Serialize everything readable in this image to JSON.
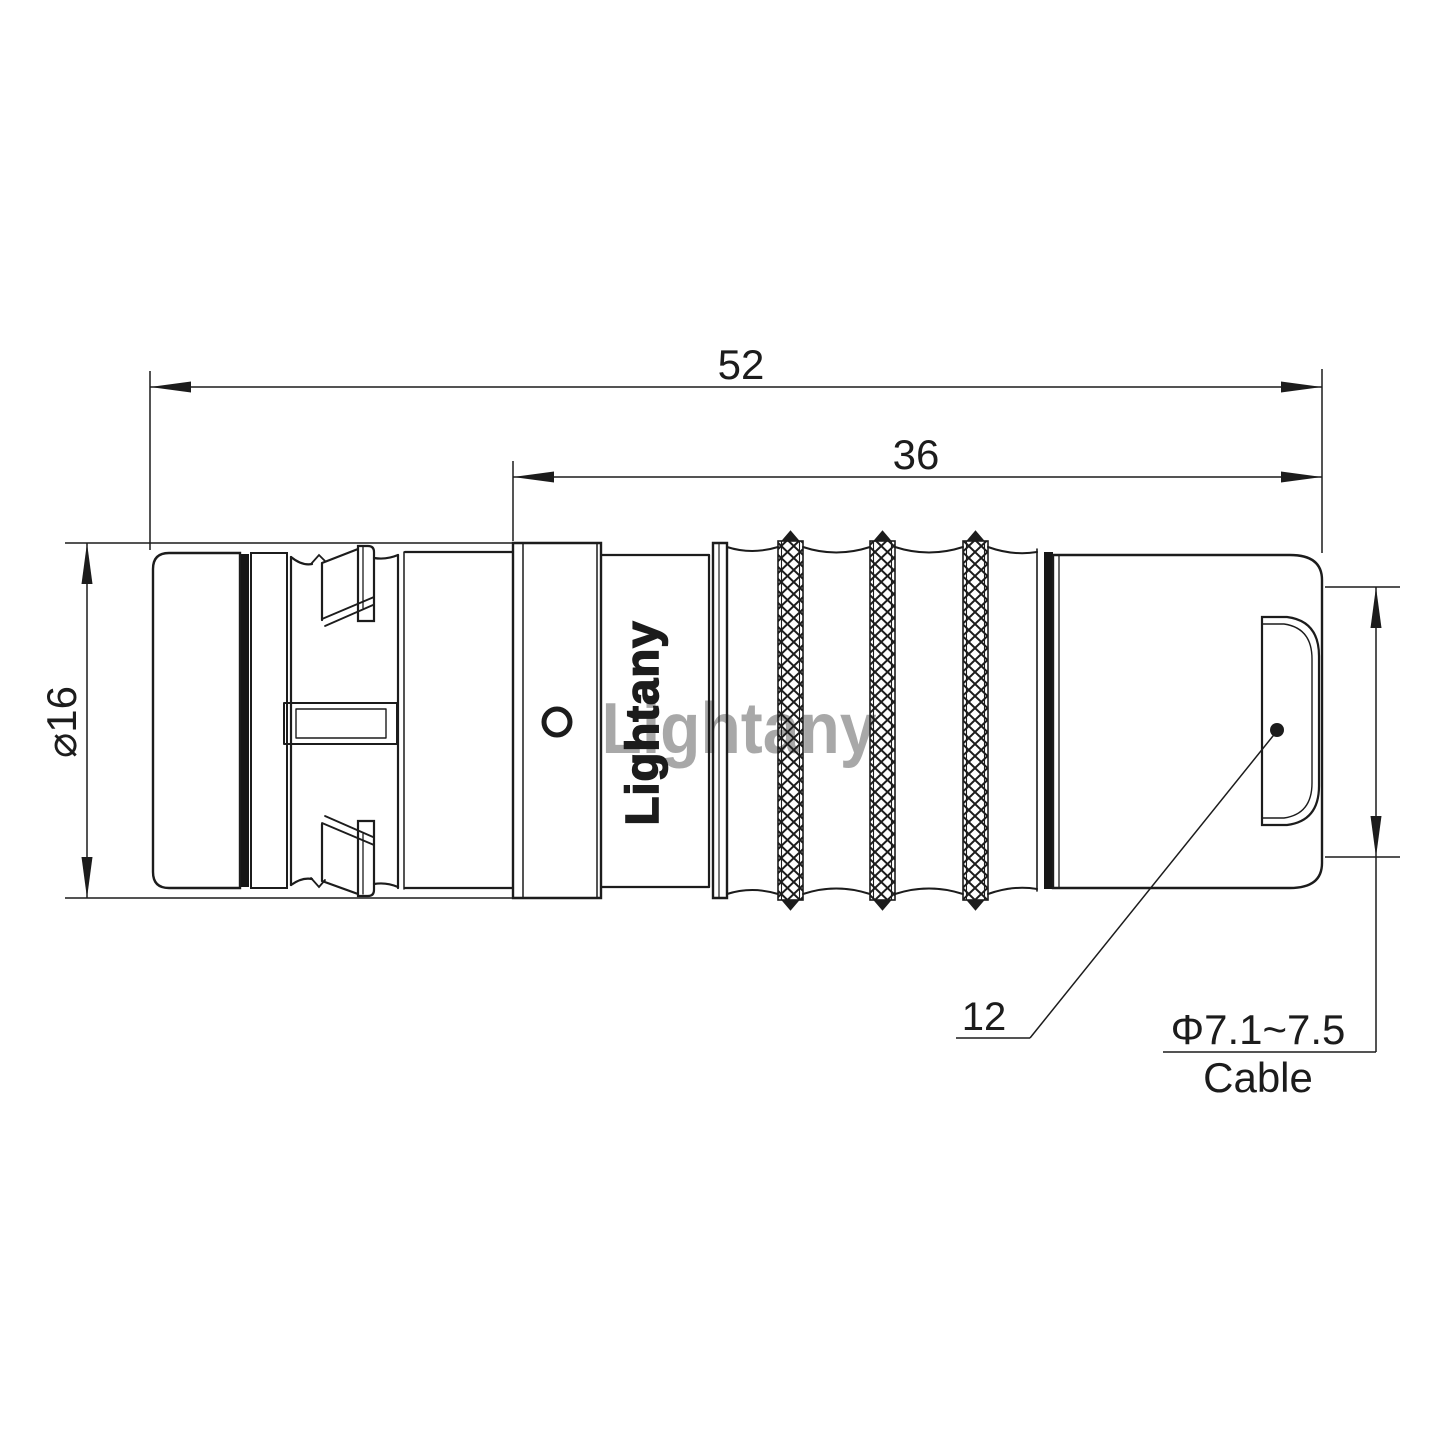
{
  "drawing": {
    "type": "connector-technical-drawing",
    "watermark": {
      "text": "Lightany",
      "color": "#e25c5c"
    },
    "engraving": {
      "text": "Lightany"
    },
    "dimensions": {
      "overall_length": "52",
      "rear_length": "36",
      "shell_diameter": "⌀16",
      "bushing_callout": "12",
      "cable_diameter_range": "Φ7.1~7.5",
      "cable_label": "Cable"
    },
    "colors": {
      "line": "#1c1c1c",
      "background": "#ffffff",
      "watermark": "#e25c5c"
    }
  }
}
